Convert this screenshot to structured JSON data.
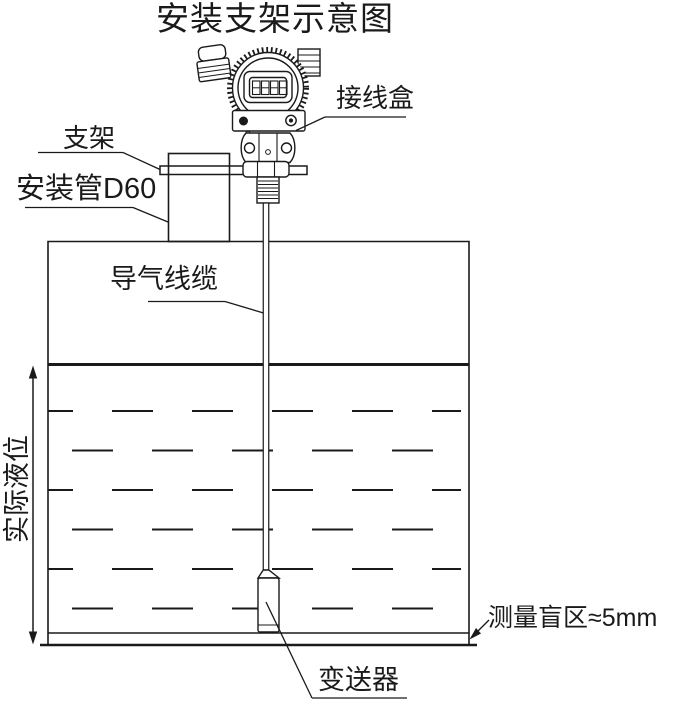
{
  "title": "安装支架示意图",
  "labels": {
    "junction_box": "接线盒",
    "bracket": "支架",
    "mounting_pipe": "安装管D60",
    "air_cable": "导气线缆",
    "actual_level": "实际液位",
    "blind_zone": "测量盲区≈5mm",
    "transmitter": "变送器"
  },
  "diagram": {
    "lcd_display_cells": 4,
    "colors": {
      "line": "#1a1a1a",
      "background": "#ffffff"
    }
  }
}
